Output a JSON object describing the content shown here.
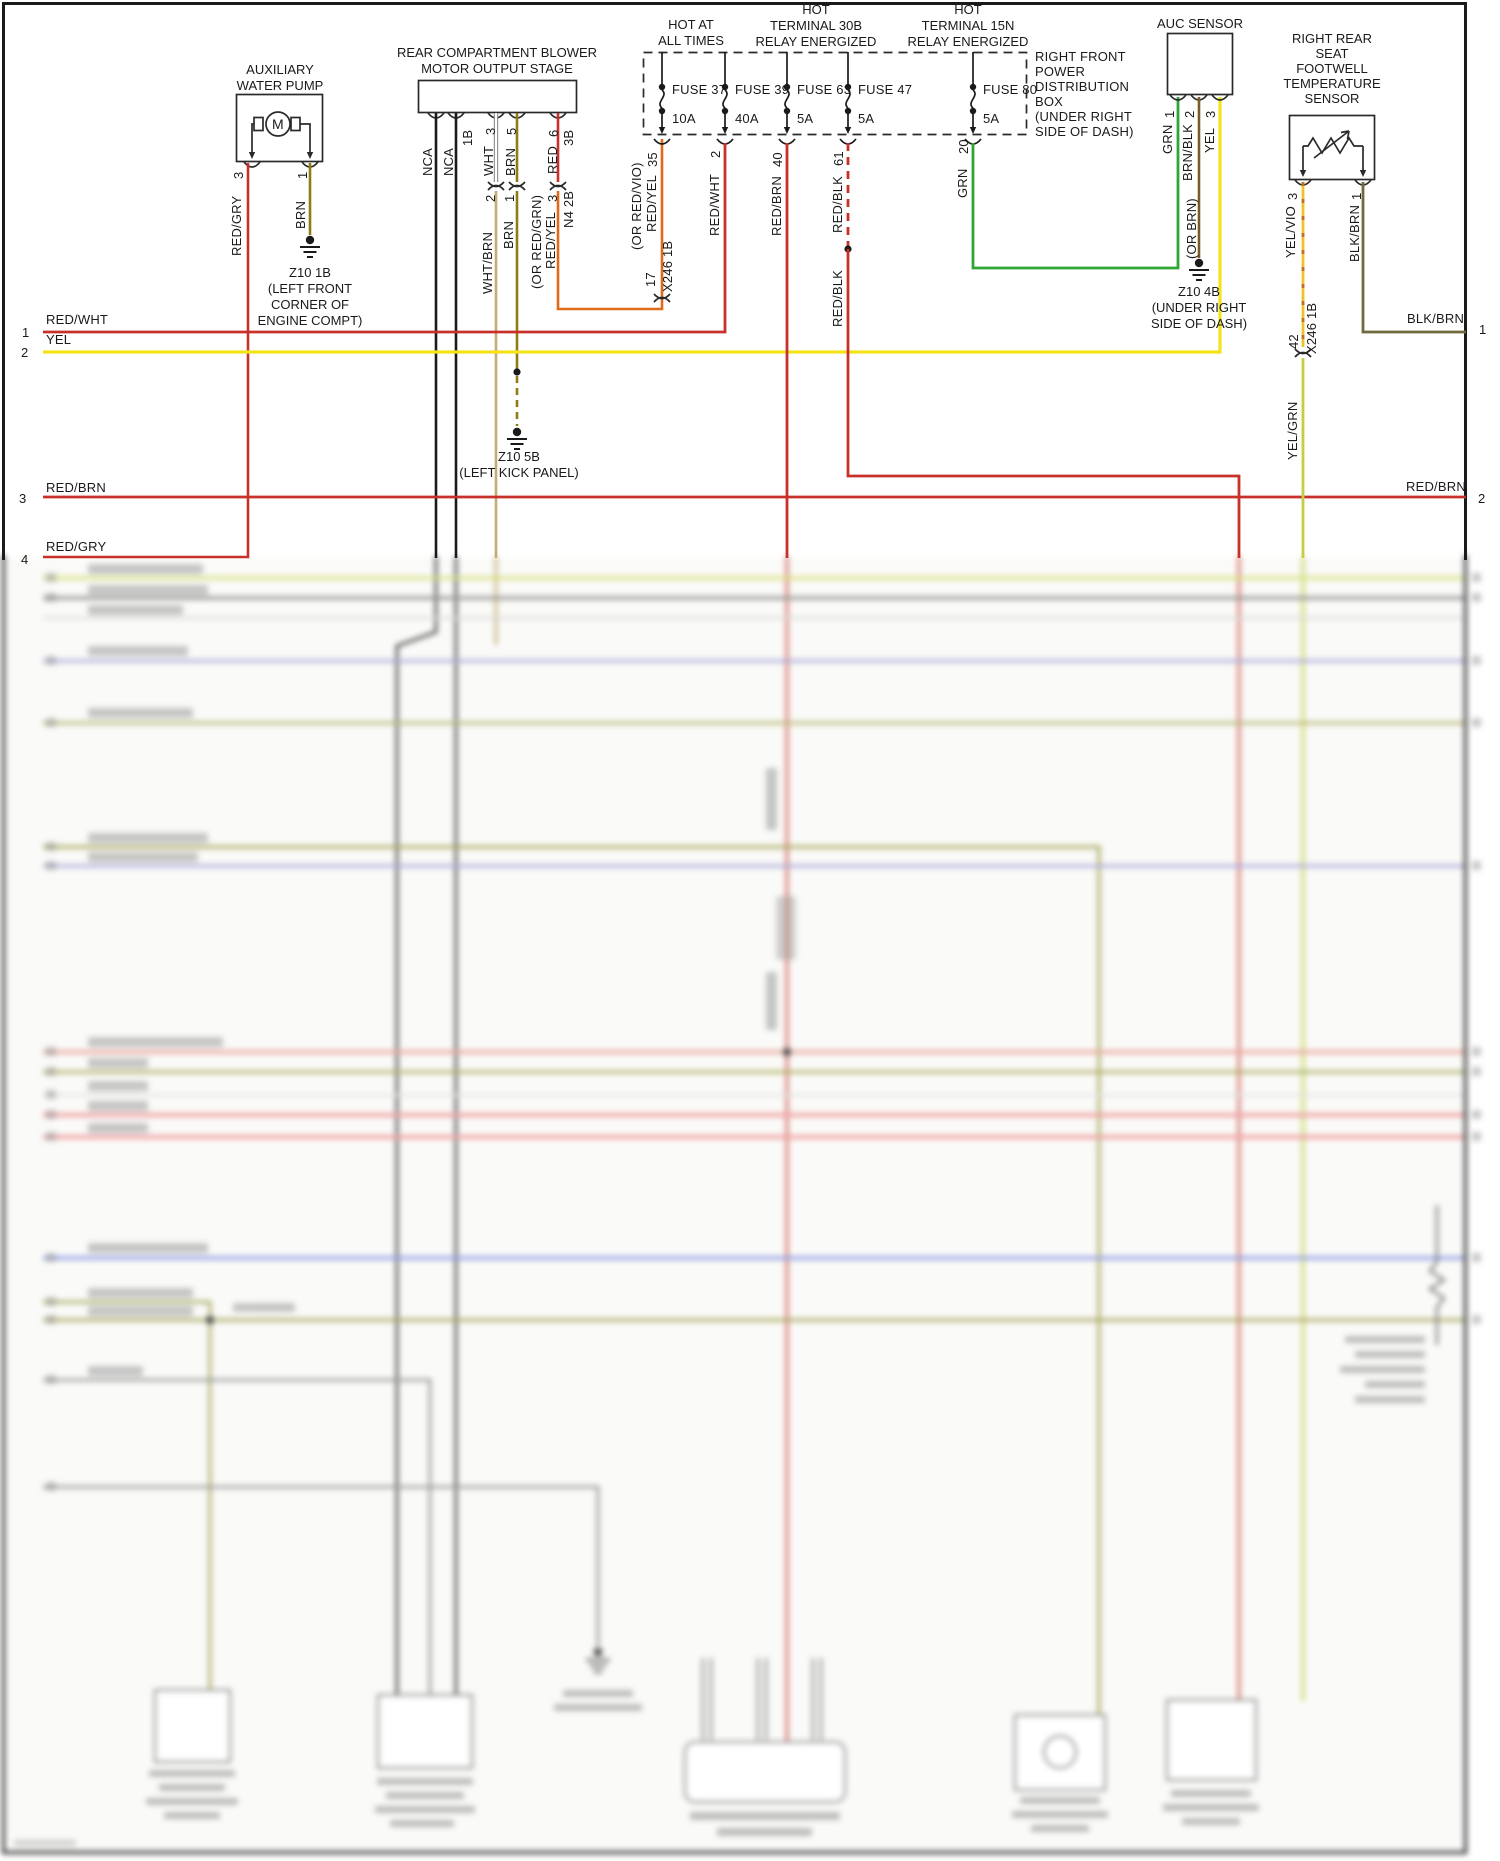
{
  "colors": {
    "red": "#c8302a",
    "yellow": "#f2e41c",
    "olive": "#8f7d12",
    "tan": "#c4ab74",
    "orange": "#e06a1a",
    "green": "#2fa633",
    "brown": "#7c5a23",
    "darkolive": "#6f6b3c",
    "chartreuse": "#c2ce44",
    "yelvio": "#ecc32a",
    "black": "#1a1a1a"
  },
  "aux_pump": {
    "title1": "AUXILIARY",
    "title2": "WATER PUMP",
    "motor": "M",
    "pin3": "3",
    "pin1": "1",
    "wire3": "RED/GRY",
    "wire1": "BRN",
    "ground": {
      "l1": "Z10 1B",
      "l2": "(LEFT FRONT",
      "l3": "CORNER OF",
      "l4": "ENGINE COMPT)"
    }
  },
  "blower": {
    "title1": "REAR COMPARTMENT BLOWER",
    "title2": "MOTOR OUTPUT STAGE",
    "pins": {
      "nca1": "NCA",
      "nca2": "NCA",
      "c1b": "1B",
      "p3": "3",
      "wht": "WHT",
      "p5": "5",
      "brn": "BRN",
      "p6": "6",
      "red": "RED",
      "c3b": "3B"
    },
    "conn": {
      "p2": "2",
      "p1": "1",
      "p3": "3",
      "name": "N4 2B",
      "whtbrn": "WHT/BRN",
      "brn": "BRN",
      "redyel_alt": "(OR RED/GRN)",
      "redyel": "RED/YEL"
    },
    "ground": {
      "l1": "Z10 5B",
      "l2": "(LEFT KICK PANEL)"
    }
  },
  "power": {
    "hdr1a": "HOT AT",
    "hdr1b": "ALL TIMES",
    "hdr2a": "HOT",
    "hdr2b": "TERMINAL 30B",
    "hdr2c": "RELAY ENERGIZED",
    "hdr3a": "HOT",
    "hdr3b": "TERMINAL 15N",
    "hdr3c": "RELAY ENERGIZED",
    "fuses": [
      {
        "name": "FUSE 37",
        "amp": "10A",
        "pin": "35",
        "wire": "RED/YEL",
        "alt": "(OR RED/VIO)"
      },
      {
        "name": "FUSE 39",
        "amp": "40A",
        "pin": "2",
        "wire": "RED/WHT"
      },
      {
        "name": "FUSE 63",
        "amp": "5A",
        "pin": "40",
        "wire": "RED/BRN"
      },
      {
        "name": "FUSE 47",
        "amp": "5A",
        "pin": "61",
        "wire": "RED/BLK",
        "wire2": "RED/BLK"
      },
      {
        "name": "FUSE 80",
        "amp": "5A",
        "pin": "20",
        "wire": "GRN"
      }
    ],
    "box_label": [
      "RIGHT FRONT",
      "POWER",
      "DISTRIBUTION",
      "BOX",
      "(UNDER RIGHT",
      "SIDE OF DASH)"
    ],
    "conn17": {
      "pin": "17",
      "name": "X246 1B"
    }
  },
  "auc": {
    "title": "AUC SENSOR",
    "p1": "1",
    "w1": "GRN",
    "p2": "2",
    "w2": "BRN/BLK",
    "alt2": "(OR BRN)",
    "p3": "3",
    "w3": "YEL",
    "ground": {
      "l1": "Z10 4B",
      "l2": "(UNDER RIGHT",
      "l3": "SIDE OF DASH)"
    }
  },
  "temp_sensor": {
    "title1": "RIGHT REAR",
    "title2": "SEAT",
    "title3": "FOOTWELL",
    "title4": "TEMPERATURE",
    "title5": "SENSOR",
    "p3": "3",
    "w3": "YEL/VIO",
    "p1": "1",
    "w1": "BLK/BRN",
    "conn42": {
      "pin": "42",
      "name": "X246 1B"
    },
    "below": "YEL/GRN"
  },
  "rows": {
    "r1": {
      "num": "1",
      "label": "RED/WHT"
    },
    "r2": {
      "num": "2",
      "label": "YEL"
    },
    "r3": {
      "num": "3",
      "label": "RED/BRN"
    },
    "r4": {
      "num": "4",
      "label": "RED/GRY"
    },
    "right1": {
      "num": "1",
      "label": "BLK/BRN"
    },
    "right2": {
      "num": "2",
      "label": "RED/BRN"
    }
  }
}
